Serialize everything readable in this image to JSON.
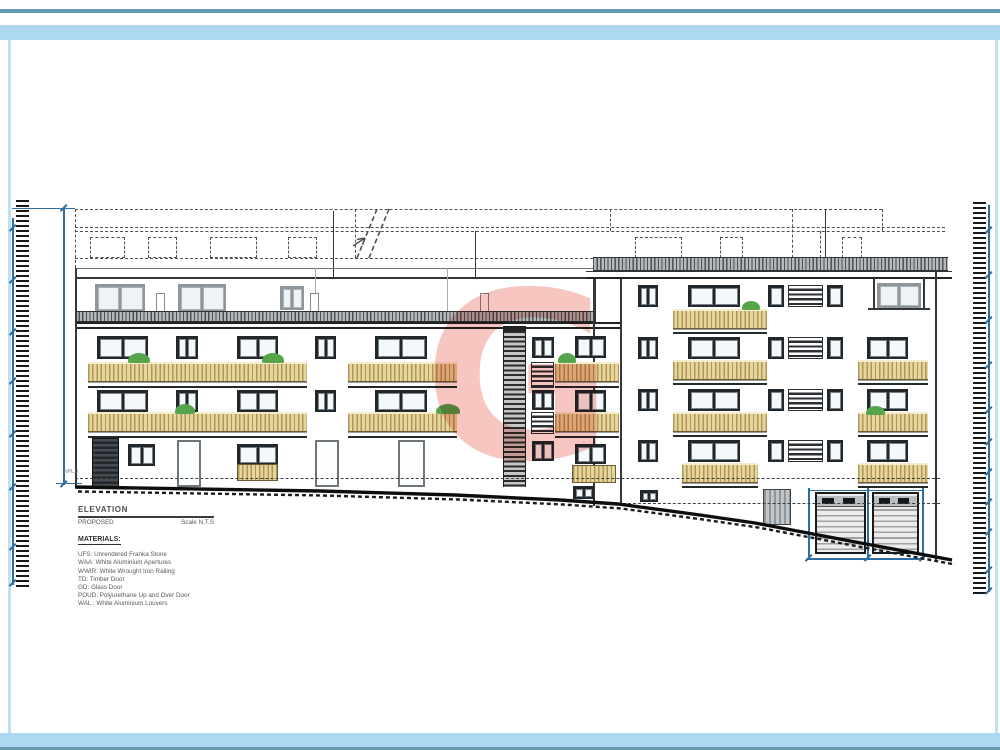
{
  "sheet": {
    "width": 1000,
    "height": 750,
    "background": "#ffffff"
  },
  "colors": {
    "frame_teal": "#6699aa",
    "frame_light_blue": "#aed7f2",
    "dimension_blue": "#2e6da0",
    "balcony_tan": "#e6d69c",
    "window_frame_dark": "#22272b",
    "penthouse_frame_grey": "#8e969c",
    "plant_green": "#56a44b",
    "watermark_salmon": "#f0988d"
  },
  "watermark": {
    "letter": "G"
  },
  "title_block": {
    "title": "ELEVATION",
    "subtitle": "PROPOSED",
    "scale_label": "Scale N.T.S",
    "materials_heading": "MATERIALS:",
    "materials": [
      "UFS: Unrendered Franka Stone",
      "WAA: White Aluminium Apertures",
      "WWIR: White Wrought Iron Railing",
      "TD: Timber Door",
      "GD: Glass Door",
      "POUD: Polyurethane Up and Over Door",
      "WAL : White Aluminium Louvers"
    ]
  },
  "annotations": {
    "level_marker": "NPL.0",
    "street_note": "··············································"
  }
}
